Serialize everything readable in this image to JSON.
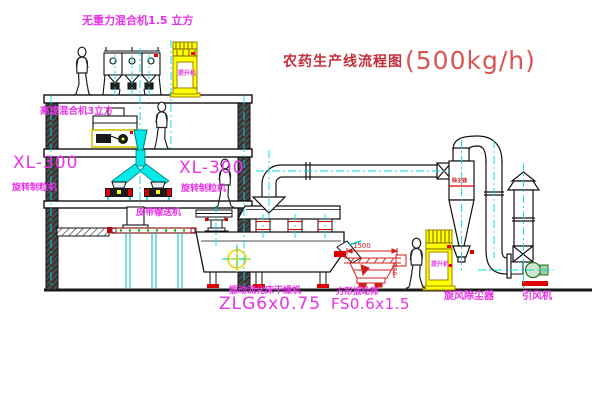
{
  "title": {
    "zh": "农药生产线流程图",
    "capacity": "(500kg/h)"
  },
  "labels": {
    "gravity_mixer": "无重力混合机1.5 立方",
    "high_speed_mixer": "高速混合机3立方",
    "granulator_left": {
      "model": "XL-300",
      "name": "旋转制粒机"
    },
    "granulator_right": {
      "model": "XL-300",
      "name": "旋转制粒机"
    },
    "belt_conveyor": "皮带输送机",
    "dryer": {
      "name": "振动流化床干燥机",
      "model": "ZLG6x0.75"
    },
    "screen": {
      "name": "方形振动筛",
      "model": "FS0.6x1.5"
    },
    "cyclone": "旋风除尘器",
    "fan": "引风机",
    "elevator_tag": "提升机",
    "cyclone_tag": "除尘器"
  },
  "dimensions": {
    "screen_width": "1500",
    "screen_height": "350"
  },
  "colors": {
    "label_magenta": "#e832e8",
    "title_red": "#c4303a",
    "centerline_cyan": "#00dddd",
    "machine_yellow": "#ffff00",
    "drawing_red": "#cf1f1f"
  }
}
